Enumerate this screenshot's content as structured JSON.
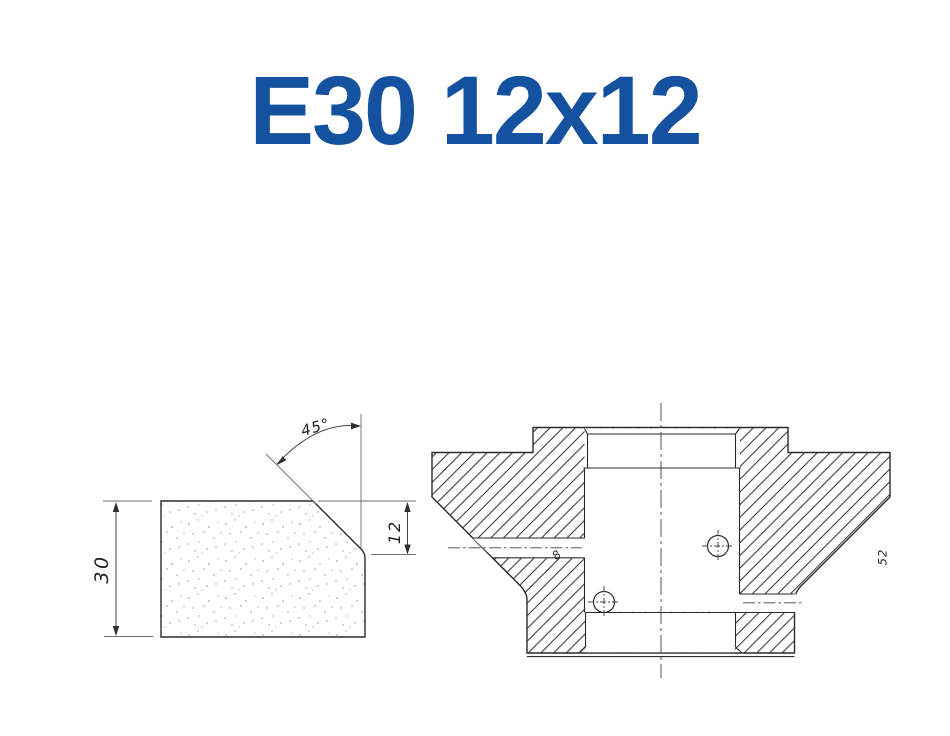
{
  "page": {
    "background": "#ffffff"
  },
  "title": {
    "text": "E30 12x12",
    "color": "#14519E"
  },
  "views": {
    "profile": {
      "description": "abrasive-profile-cross-section",
      "dim_height": "30",
      "dim_chamfer_depth": "12",
      "dim_chamfer_angle": "45°"
    },
    "section": {
      "description": "wheel-body-cross-section",
      "dim_hole": "8",
      "dim_right": "52"
    }
  }
}
